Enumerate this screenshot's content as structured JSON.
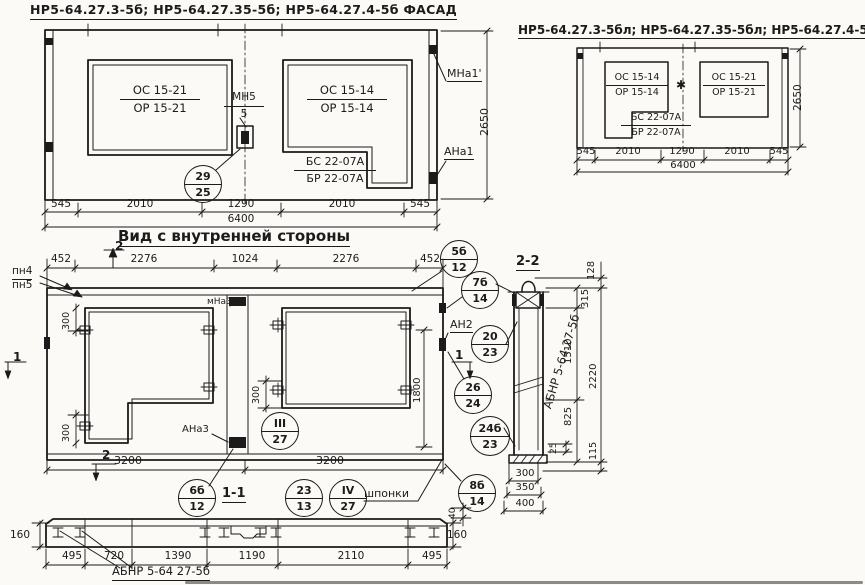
{
  "fl": {
    "title": "НР5-64.27.3-5б; НР5-64.27.35-5б; НР5-64.27.4-5б ФАСАД",
    "win_left_top": "ОС 15-21",
    "win_left_bot": "ОР 15-21",
    "win_right_top": "ОС 15-14",
    "win_right_bot": "ОР 15-14",
    "mn_top": "МН5",
    "mn_bot": "5",
    "step_top": "БС 22-07А",
    "step_bot": "БР 22-07А",
    "call_top": "29",
    "call_bot": "25",
    "mark_tr": "МНа1'",
    "mark_br": "АНа1",
    "height": "2650",
    "dims": [
      "545",
      "2010",
      "1290",
      "2010",
      "545"
    ],
    "total": "6400"
  },
  "fr": {
    "title": "НР5-64.27.3-5бл; НР5-64.27.35-5бл; НР5-64.27.4-5б ФАСАД",
    "win_left_top": "ОС 15-14",
    "win_left_bot": "ОР 15-14",
    "win_right_top": "ОС 15-21",
    "win_right_bot": "ОР 15-21",
    "step_top": "БС 22-07А",
    "step_bot": "БР 22-07А",
    "star": "✱",
    "height": "2650",
    "dims": [
      "545",
      "2010",
      "1290",
      "2010",
      "545"
    ],
    "total": "6400"
  },
  "iv": {
    "title": "Вид с внутренней стороны",
    "dims_top": [
      "452",
      "2276",
      "1024",
      "2276",
      "452"
    ],
    "pn4": "пн4",
    "pn5": "пн5",
    "mna3": "мНа3",
    "ana3": "АНа3",
    "an2": "АН2",
    "m1": "1",
    "m2": "2",
    "d300": "300",
    "d1800": "1800",
    "d3200": "3200",
    "d40": "40",
    "shponki": "шпонки",
    "sec11": "1-1",
    "c5b": [
      "5б",
      "12"
    ],
    "c7b": [
      "7б",
      "14"
    ],
    "c20": [
      "20",
      "23"
    ],
    "c26": [
      "26",
      "24"
    ],
    "c24b": [
      "24б",
      "23"
    ],
    "c8b": [
      "8б",
      "14"
    ],
    "c6b": [
      "6б",
      "12"
    ],
    "c23": [
      "23",
      "13"
    ],
    "c3": [
      "III",
      "27"
    ],
    "c4": [
      "IV",
      "27"
    ]
  },
  "s1": {
    "dims": [
      "495",
      "720",
      "1390",
      "1190",
      "2110",
      "495"
    ],
    "h": "160",
    "label": "АБНР 5-64 27-5б"
  },
  "s2": {
    "title": "2-2",
    "label": "АБНР 5-64.27-5б",
    "d128": "128",
    "d315": "315",
    "d1510": "1510",
    "d2220": "2220",
    "d825": "825",
    "d25": "25",
    "d115": "115",
    "widths": [
      "300",
      "350",
      "400"
    ]
  }
}
